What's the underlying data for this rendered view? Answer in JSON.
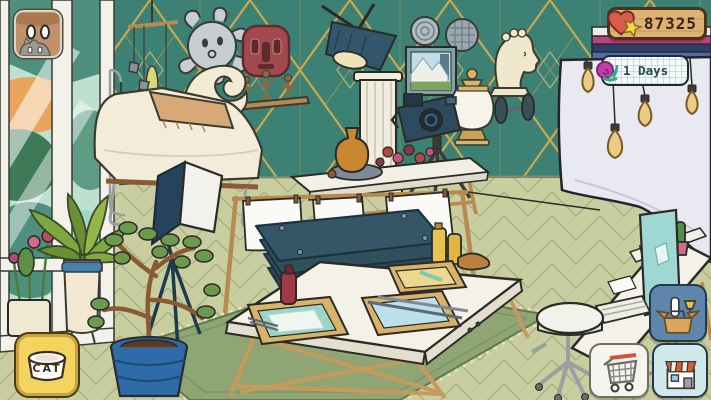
{
  "hud": {
    "heart_counter": {
      "value": "87325",
      "icon": "heart-plus-icon",
      "heart_color": "#D95B4A",
      "plus_color": "#F2D44F"
    },
    "days_badge": {
      "label": "1 Days",
      "icon": "snail-icon",
      "shell_color": "#C03FA8",
      "body_color": "#4EC9B0"
    },
    "cat_button": {
      "label": "CAT",
      "icon": "cat-bowl-icon",
      "bg_color": "#F3D45E"
    },
    "avatar_button": {
      "icon": "residents-avatar-icon"
    },
    "furniture_button": {
      "icon": "furniture-box-icon",
      "bg_color": "#5E86AC"
    },
    "cart_button": {
      "icon": "shopping-cart-icon"
    },
    "shop_button": {
      "icon": "shop-house-icon"
    }
  },
  "scene_objects": [
    "window-with-garden-view",
    "hanging-stone-mobile",
    "sun-face-mask",
    "red-tribal-mask",
    "figurine-shelf",
    "wave-sculpture",
    "spotlight-on-column",
    "decorative-wall-plates",
    "landscape-painting",
    "greek-bust",
    "white-urn",
    "wall-dumbbell",
    "camera-on-tripod",
    "photo-backdrop-with-bulbs",
    "chaise-lounge",
    "pendant-bulb",
    "side-table-with-vase",
    "paper-drying-rack",
    "paper-press-stack",
    "area-rug",
    "papermaking-work-table",
    "softbox-light",
    "potted-plant",
    "potted-tree",
    "flower-pots",
    "computer-desk",
    "rolling-stool"
  ],
  "colors": {
    "wallpaper": "#3D8174",
    "wallpaper_gold": "#C9A94F",
    "floor": "#C9CEA1",
    "rug": "#8FA573",
    "backdrop": "#E9E9F2",
    "press_boards": "#2E4F5C",
    "wood": "#B98A4F",
    "cream": "#F2EAD2"
  }
}
